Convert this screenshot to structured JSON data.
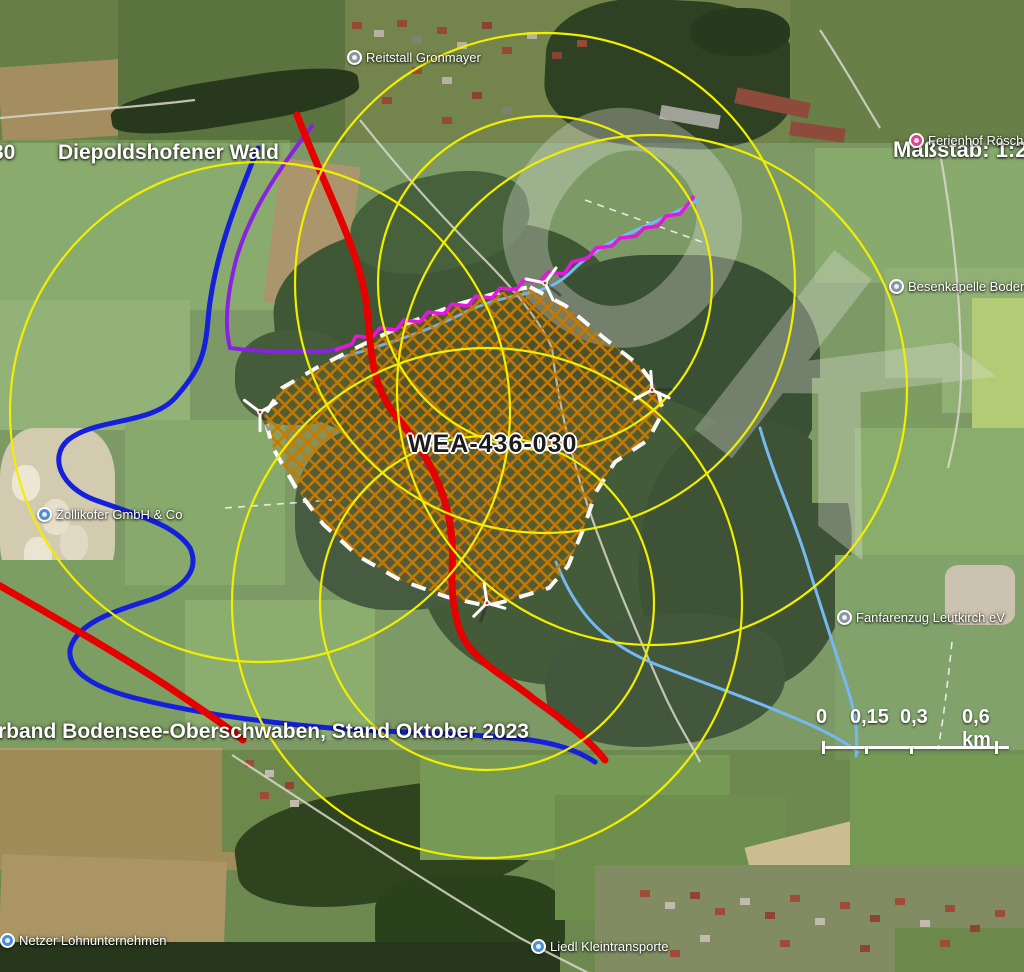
{
  "labels": {
    "clipped_number": "30",
    "forest_name": "Diepoldshofener Wald",
    "scale_note": "Maßstab: 1:20.0",
    "site_id": "WEA-436-030",
    "attribution": "rband Bodensee-Oberschwaben, Stand Oktober 2023",
    "watermark": "OK"
  },
  "pois": [
    {
      "label": "Reitstall Gronmayer",
      "type": "generic"
    },
    {
      "label": "Ferienhof Rösch Allgä",
      "type": "lodging"
    },
    {
      "label": "Besenkapelle Bodenhaus",
      "type": "generic"
    },
    {
      "label": "Zollikofer GmbH & Co",
      "type": "business"
    },
    {
      "label": "Fanfarenzug Leutkirch eV",
      "type": "generic"
    },
    {
      "label": "Netzer Lohnunternehmen",
      "type": "business"
    },
    {
      "label": "Liedl Kleintransporte",
      "type": "business"
    }
  ],
  "scale_bar": {
    "ticks": [
      "0",
      "0,15",
      "0,3",
      "0,6 km"
    ]
  },
  "site": {
    "id": "WEA-436-030",
    "boundary_style": "white dashed",
    "fill_style": "orange crosshatch",
    "turbine_count": 4
  },
  "colors": {
    "buffer_circle": "#f2ee00",
    "route_red": "#e60000",
    "route_blue": "#1520dc",
    "route_violet": "#8822e0",
    "stream_magenta": "#e318dd",
    "stream_lightblue": "#74b9f2",
    "site_hatch": "#c87a00",
    "site_boundary": "#ffffff"
  }
}
